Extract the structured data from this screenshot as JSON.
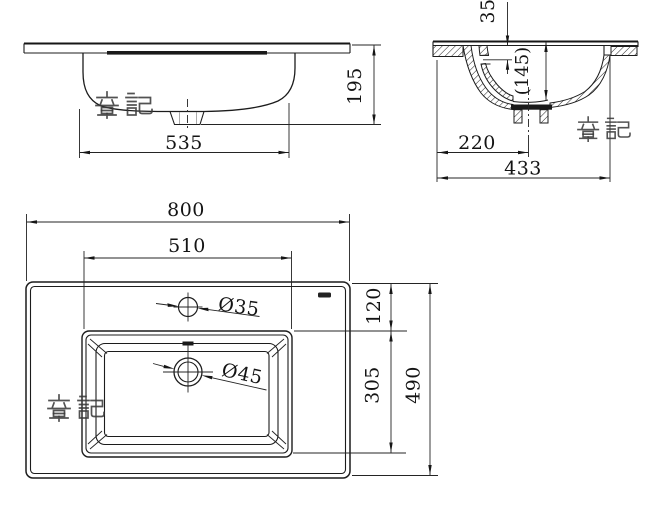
{
  "drawing": {
    "background": "#ffffff",
    "line_color": "#1c1c1c"
  },
  "watermark": {
    "text": "章記",
    "color": "#3a3a3a",
    "instances": 3
  },
  "brand_mark": {
    "icon": "small-dark-logo-mark"
  },
  "views": {
    "front": {
      "label": "front elevation",
      "dim_bowl_width": "535",
      "dim_height": "195"
    },
    "section": {
      "label": "side section",
      "dim_rim_drop": "35",
      "dim_bowl_depth": "(145)",
      "dim_drain_offset": "220",
      "dim_overall": "433"
    },
    "plan": {
      "label": "top plan",
      "dim_overall_width": "800",
      "dim_bowl_width": "510",
      "dim_faucet_hole": "Ø35",
      "dim_back_ledge": "120",
      "dim_bowl_front": "305",
      "dim_overall_depth": "490"
    }
  }
}
